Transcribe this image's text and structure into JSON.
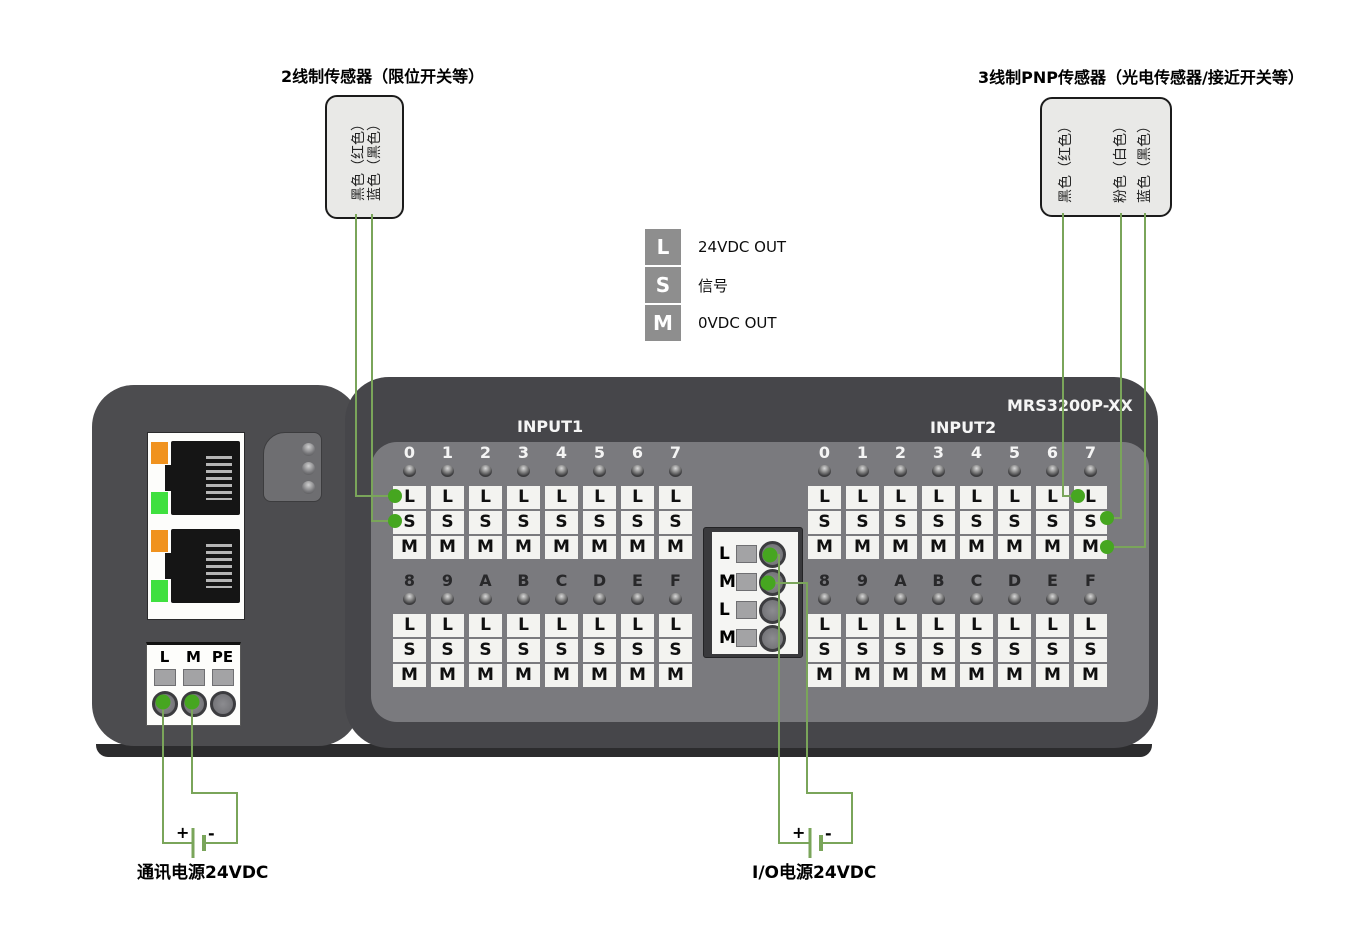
{
  "titles": {
    "sensor_2wire": "2线制传感器（限位开关等）",
    "sensor_3wire": "3线制PNP传感器（光电传感器/接近开关等）"
  },
  "sensors": {
    "two_wire": {
      "wires": [
        "黑色（红色）",
        "蓝色（黑色）"
      ]
    },
    "three_wire": {
      "wires": [
        "黑色（红色）",
        "粉色（白色）",
        "蓝色（黑色）"
      ]
    }
  },
  "legend": {
    "items": [
      {
        "key": "L",
        "label": "24VDC OUT"
      },
      {
        "key": "S",
        "label": "信号"
      },
      {
        "key": "M",
        "label": "0VDC OUT"
      }
    ]
  },
  "device": {
    "model": "MRS3200P-XX",
    "group1_label": "INPUT1",
    "group2_label": "INPUT2",
    "terminal_letters": [
      "L",
      "S",
      "M"
    ],
    "groups": [
      {
        "name": "INPUT1",
        "rows": [
          [
            "0",
            "1",
            "2",
            "3",
            "4",
            "5",
            "6",
            "7"
          ],
          [
            "8",
            "9",
            "A",
            "B",
            "C",
            "D",
            "E",
            "F"
          ]
        ]
      },
      {
        "name": "INPUT2",
        "rows": [
          [
            "0",
            "1",
            "2",
            "3",
            "4",
            "5",
            "6",
            "7"
          ],
          [
            "8",
            "9",
            "A",
            "B",
            "C",
            "D",
            "E",
            "F"
          ]
        ]
      }
    ]
  },
  "io_power_block": {
    "rows": [
      "L",
      "M",
      "L",
      "M"
    ]
  },
  "comm_power_block": {
    "labels": [
      "L",
      "M",
      "PE"
    ]
  },
  "power": {
    "comm_label": "通讯电源24VDC",
    "io_label": "I/O电源24VDC",
    "plus": "+",
    "minus": "-"
  },
  "colors": {
    "wire_green": "#7aa55a",
    "dot_green": "#46a620",
    "led_orange": "#f0921e",
    "led_green": "#3fe03f",
    "device_body": "#4c4c4f",
    "faceplate": "#46464a",
    "terminal_panel": "#7a7a7e",
    "terminal_white": "#f3f3f0",
    "legend_gray": "#8e8e8e"
  }
}
